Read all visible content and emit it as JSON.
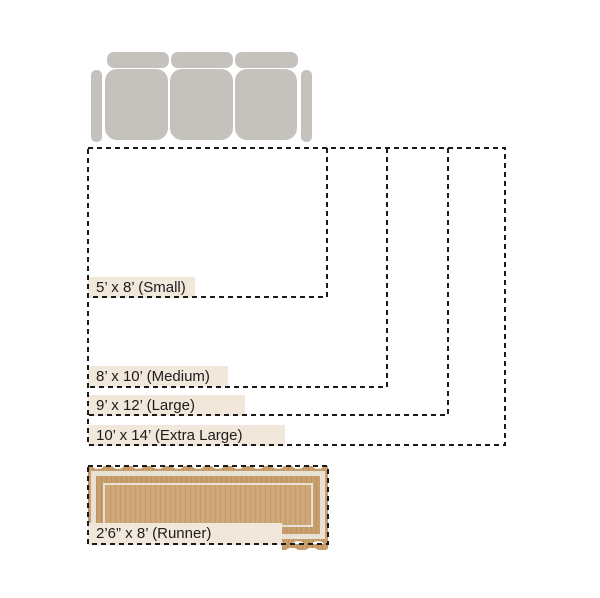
{
  "colors": {
    "sofa": "#c5c2be",
    "dash": "#1a1a1a",
    "text": "#1c1c1c",
    "label_bg": "#f1e7da",
    "rug_tan": "#c89d6a",
    "rug_tan_light": "#cfa776",
    "rug_band_white": "#e8e2d6",
    "background": "#ffffff"
  },
  "sofa": {
    "icon": "sofa-top-view"
  },
  "rugs": [
    {
      "id": "small",
      "label": "5’ x 8’ (Small)",
      "width_ft": 8,
      "depth_ft": 5
    },
    {
      "id": "medium",
      "label": "8’ x 10’ (Medium)",
      "width_ft": 10,
      "depth_ft": 8
    },
    {
      "id": "large",
      "label": "9’ x 12’ (Large)",
      "width_ft": 12,
      "depth_ft": 9
    },
    {
      "id": "extra-large",
      "label": "10’ x 14’ (Extra Large)",
      "width_ft": 14,
      "depth_ft": 10
    },
    {
      "id": "runner",
      "label": "2’6” x 8’ (Runner)",
      "width_ft": 8,
      "depth_ft": 2.5
    }
  ]
}
